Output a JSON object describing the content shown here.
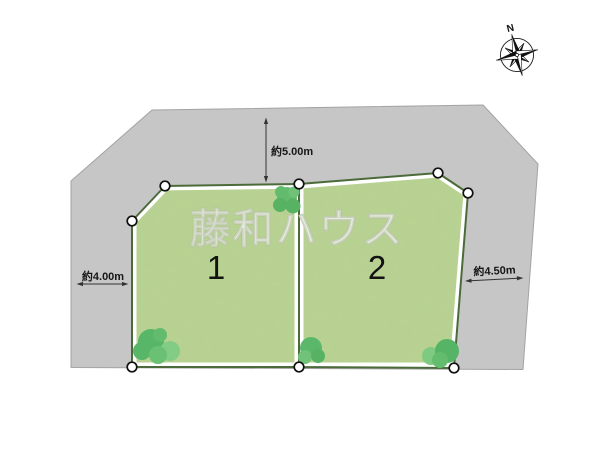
{
  "diagram": {
    "watermark": "藤和ハウス",
    "compass_label": "N",
    "plots": [
      {
        "number": "1"
      },
      {
        "number": "2"
      }
    ],
    "dimensions": {
      "top": "約5.00m",
      "left": "約4.00m",
      "right": "約4.50m"
    }
  },
  "colors": {
    "background": "#ffffff",
    "surrounding_land": "#c6c6c6",
    "surrounding_border": "#a3a3a3",
    "plot_fill": "#b9d292",
    "plot_outline": "#4c6b3a",
    "plot_inner_band": "#ffffff",
    "tree_green": "#57b667",
    "tree_green_light": "#82cc86",
    "dimension_text": "#161616",
    "watermark_text": "#eceee4"
  }
}
